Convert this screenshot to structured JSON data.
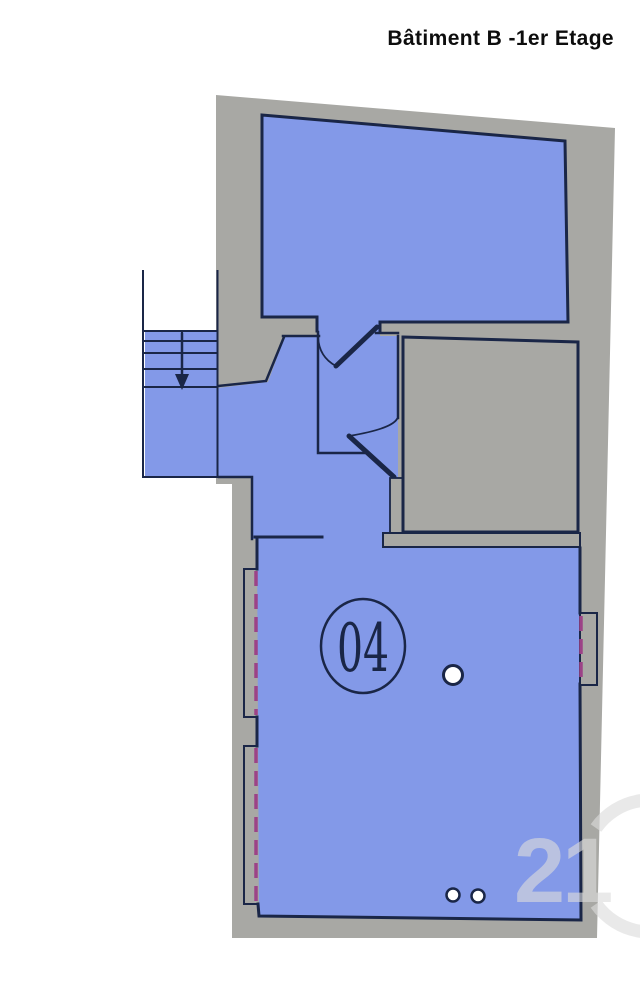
{
  "title": "Bâtiment B -1er Etage",
  "plan": {
    "room_number": "04",
    "watermark_number": "21",
    "colors": {
      "background": "#FFFFFF",
      "room_fill": "#8399E8",
      "wall_fill": "#A8A8A4",
      "outline": "#1A2647",
      "window_dash": "#9C4287",
      "watermark": "#DCDCDC",
      "title_color": "#0D0D0D"
    }
  }
}
